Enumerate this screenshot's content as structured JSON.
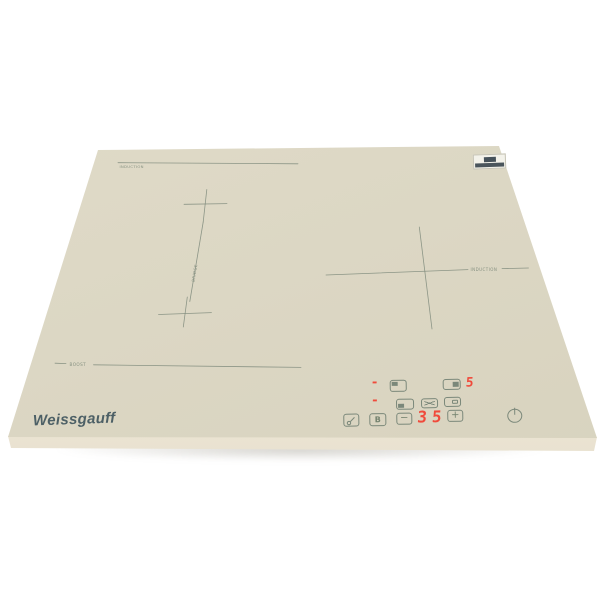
{
  "product": {
    "type": "built-in induction cooktop, beige glass, product photo",
    "brand": "Weissgauff"
  },
  "colors": {
    "background": "#ffffff",
    "glass": "#dbd6c3",
    "glass_edge": "#f1ebda",
    "marking": "#7e8a7b",
    "logo": "#4d6066",
    "led": "#f04a3b"
  },
  "surface_markings": {
    "rear_left_label": "INDUCTION",
    "boost_label": "BOOST",
    "bridge_label": "BRIDGE",
    "right_zone_label": "INDUCTION"
  },
  "display": {
    "left_rear_indicator": "-",
    "left_front_indicator": "-",
    "right_power_level": "5",
    "main_display": "35"
  },
  "buttons": {
    "boost": "B",
    "minus": "−",
    "plus": "+"
  }
}
